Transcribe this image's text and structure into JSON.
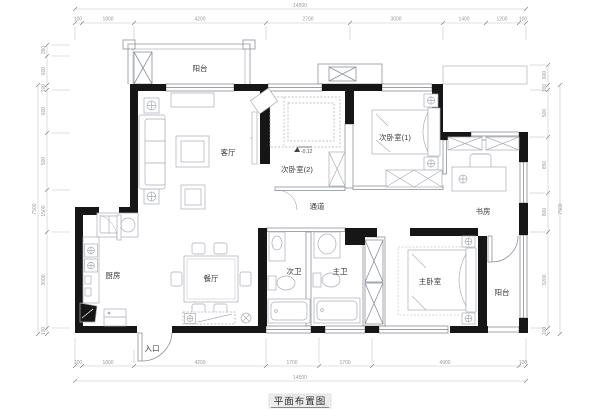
{
  "title": "平面布置图",
  "plan": {
    "elevation": "-0.12",
    "rooms": {
      "balcony_top": {
        "label": "阳台"
      },
      "living": {
        "label": "客厅"
      },
      "bedroom2": {
        "label": "次卧室(2)"
      },
      "bedroom1": {
        "label": "次卧室(1)"
      },
      "study": {
        "label": "书房"
      },
      "corridor": {
        "label": "通道"
      },
      "kitchen": {
        "label": "厨房"
      },
      "dining": {
        "label": "餐厅"
      },
      "bath_guest": {
        "label": "次卫"
      },
      "bath_master": {
        "label": "主卫"
      },
      "bedroom_master": {
        "label": "主卧室"
      },
      "balcony_bottom": {
        "label": "阳台"
      },
      "entry": {
        "label": "入口"
      }
    }
  },
  "dims": {
    "top": {
      "total": "14500",
      "segments": [
        "100",
        "1800",
        "4200",
        "2700",
        "3000",
        "1400",
        "1200",
        "100"
      ]
    },
    "bottom": {
      "total": "14500",
      "segments": [
        "100",
        "1800",
        "4200",
        "1700",
        "1700",
        "4900",
        "100"
      ]
    },
    "left": {
      "total": "7500",
      "segments": [
        "350",
        "600",
        "100",
        "600",
        "500",
        "1500",
        "3000",
        "100"
      ]
    },
    "right": {
      "total": "7500",
      "segments": [
        "600",
        "100",
        "500",
        "850",
        "800",
        "3200",
        "100"
      ]
    }
  },
  "colors": {
    "wall": "#161616",
    "furniture": "#a9aeb6",
    "thin": "#8d929a",
    "dim": "#c0c0c0"
  }
}
